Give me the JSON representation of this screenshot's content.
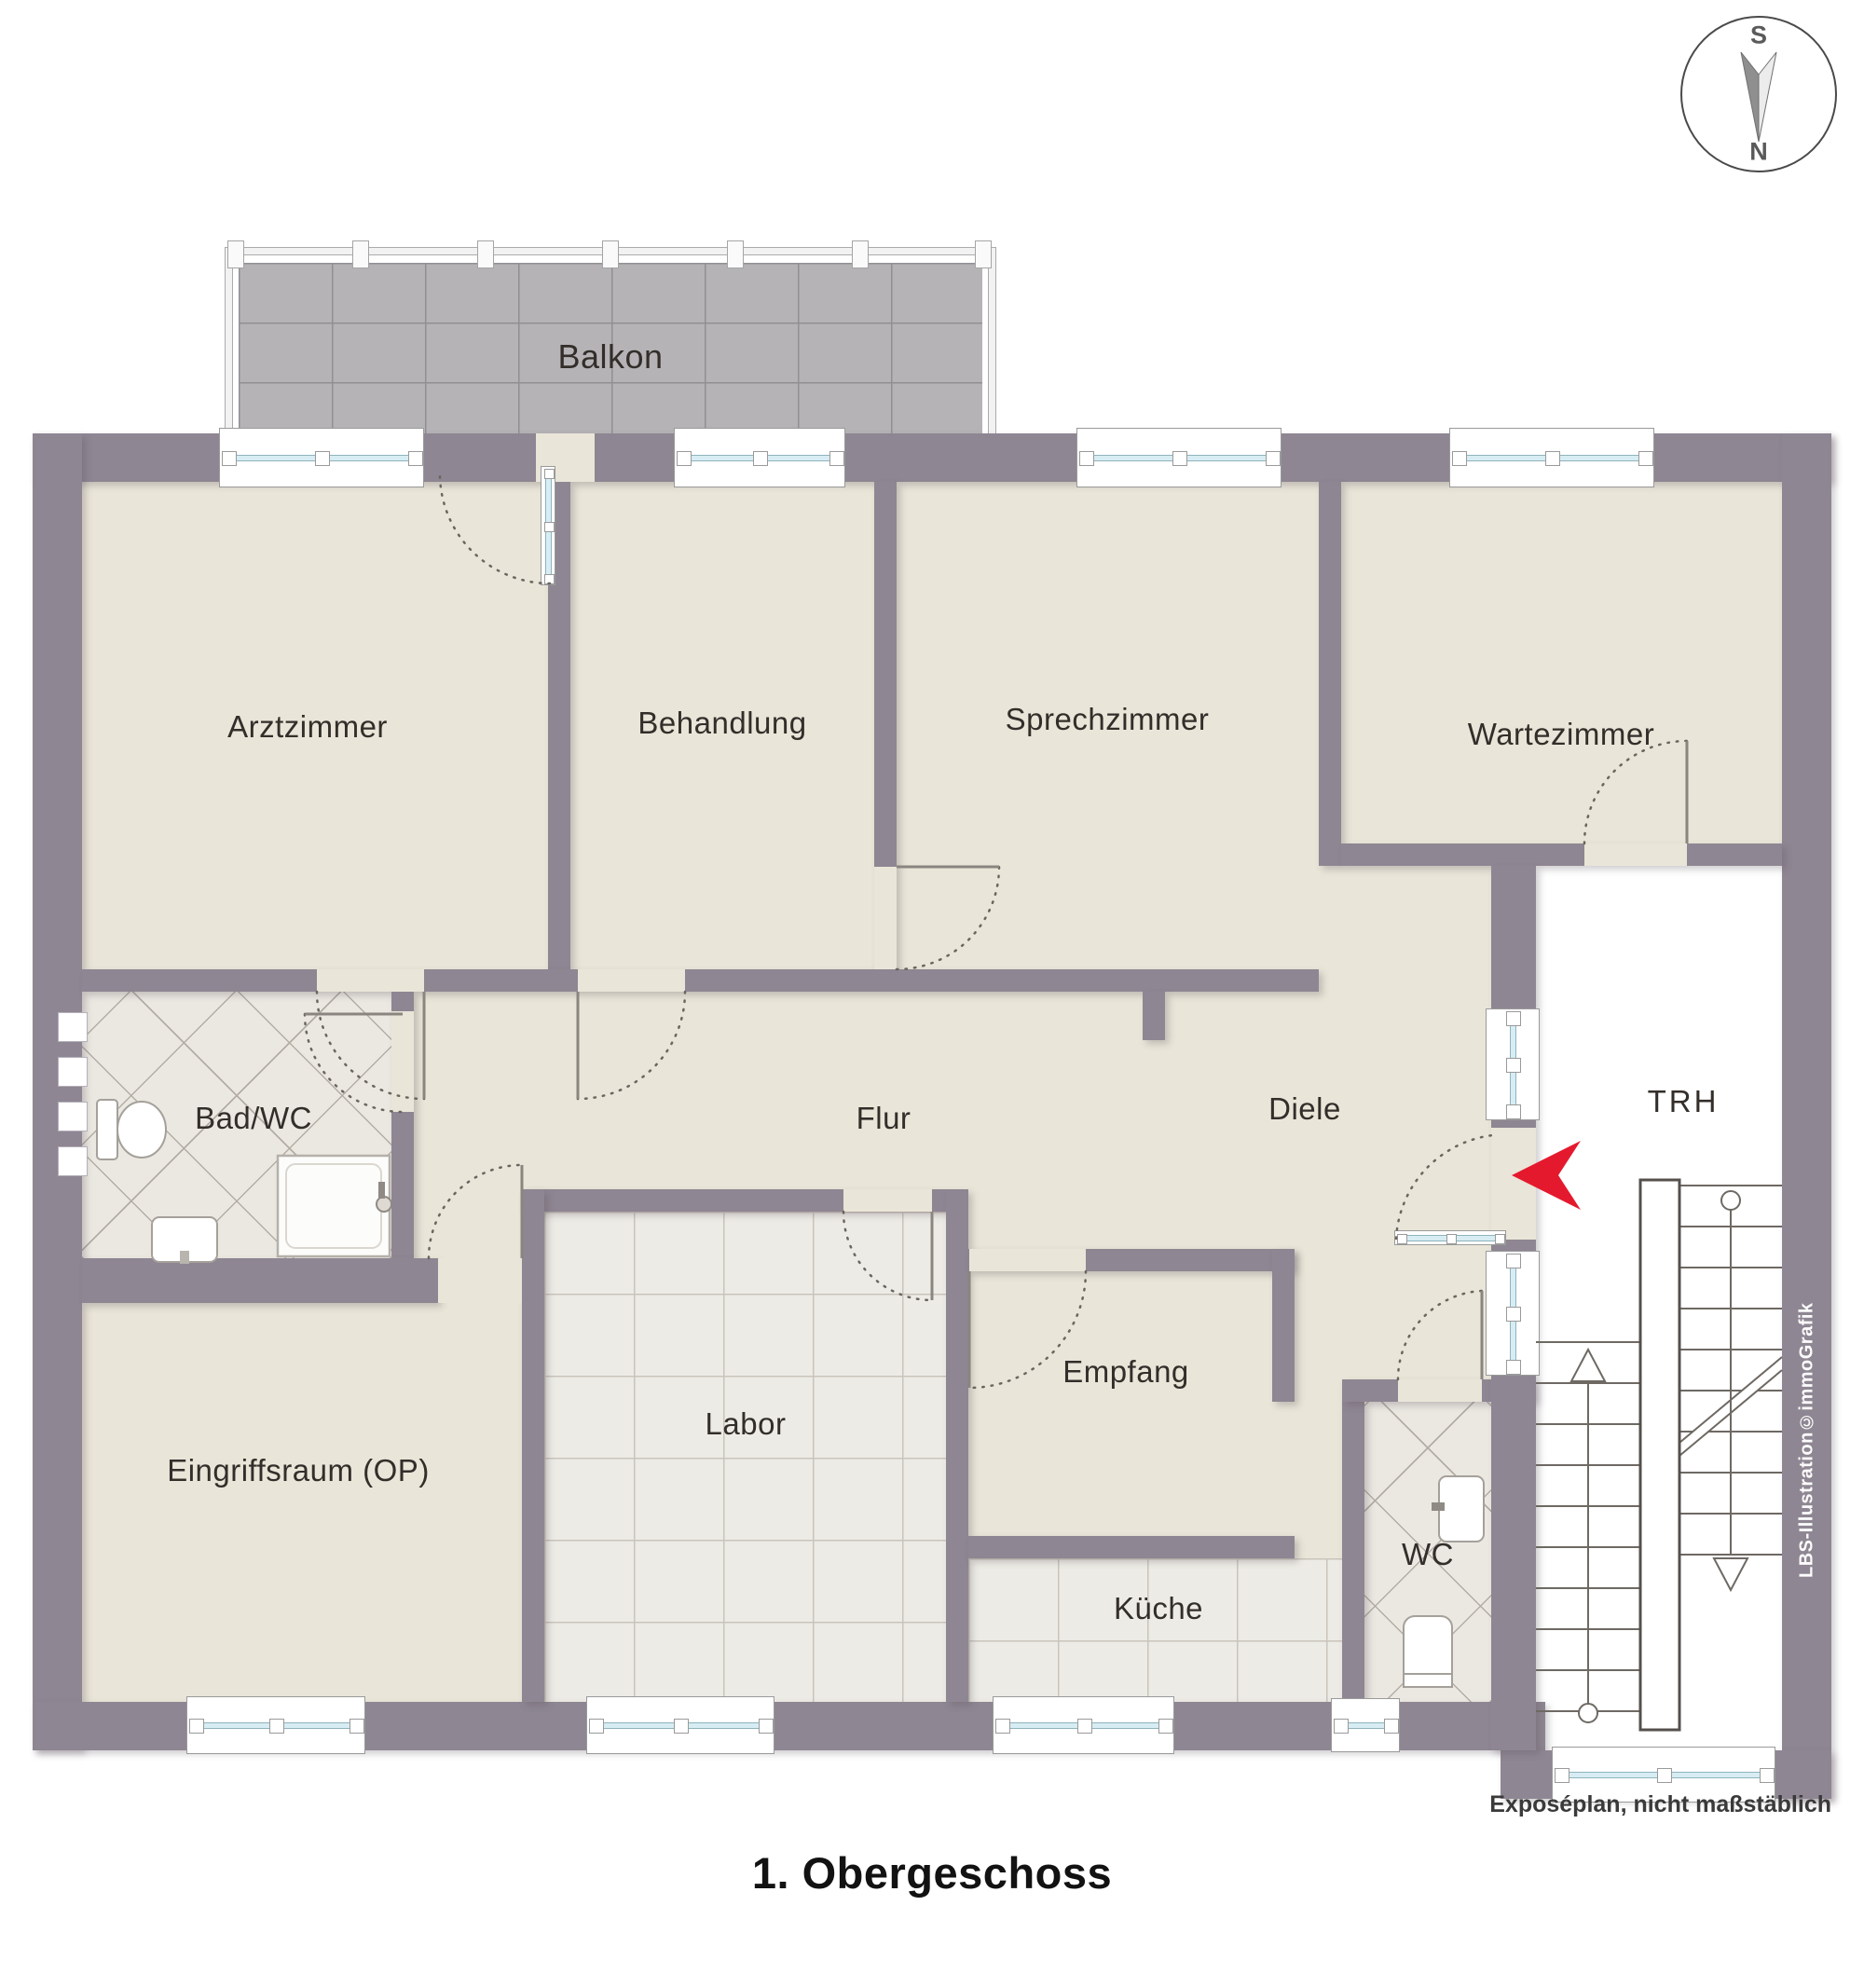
{
  "title": "1. Obergeschoss",
  "footnote": "Exposéplan, nicht maßstäblich",
  "watermark": "LBS-Illustration©immoGrafik",
  "compass": {
    "south": "S",
    "north": "N"
  },
  "rooms": [
    {
      "id": "balkon",
      "label": "Balkon"
    },
    {
      "id": "arztzimmer",
      "label": "Arztzimmer"
    },
    {
      "id": "behandlung",
      "label": "Behandlung"
    },
    {
      "id": "sprechzimmer",
      "label": "Sprechzimmer"
    },
    {
      "id": "wartezimmer",
      "label": "Wartezimmer"
    },
    {
      "id": "bad-wc",
      "label": "Bad/WC"
    },
    {
      "id": "flur",
      "label": "Flur"
    },
    {
      "id": "diele",
      "label": "Diele"
    },
    {
      "id": "trh",
      "label": "TRH"
    },
    {
      "id": "eingriffsraum",
      "label": "Eingriffsraum (OP)"
    },
    {
      "id": "labor",
      "label": "Labor"
    },
    {
      "id": "empfang",
      "label": "Empfang"
    },
    {
      "id": "kueche",
      "label": "Küche"
    },
    {
      "id": "wc",
      "label": "WC"
    }
  ],
  "colors": {
    "wall": "#8e8692",
    "floor": "#e9e5d8",
    "tile": "#edebe5",
    "balcony_tile": "#b5b3b6",
    "glass": "#d7edf3",
    "entrance_arrow": "#e5192d"
  }
}
